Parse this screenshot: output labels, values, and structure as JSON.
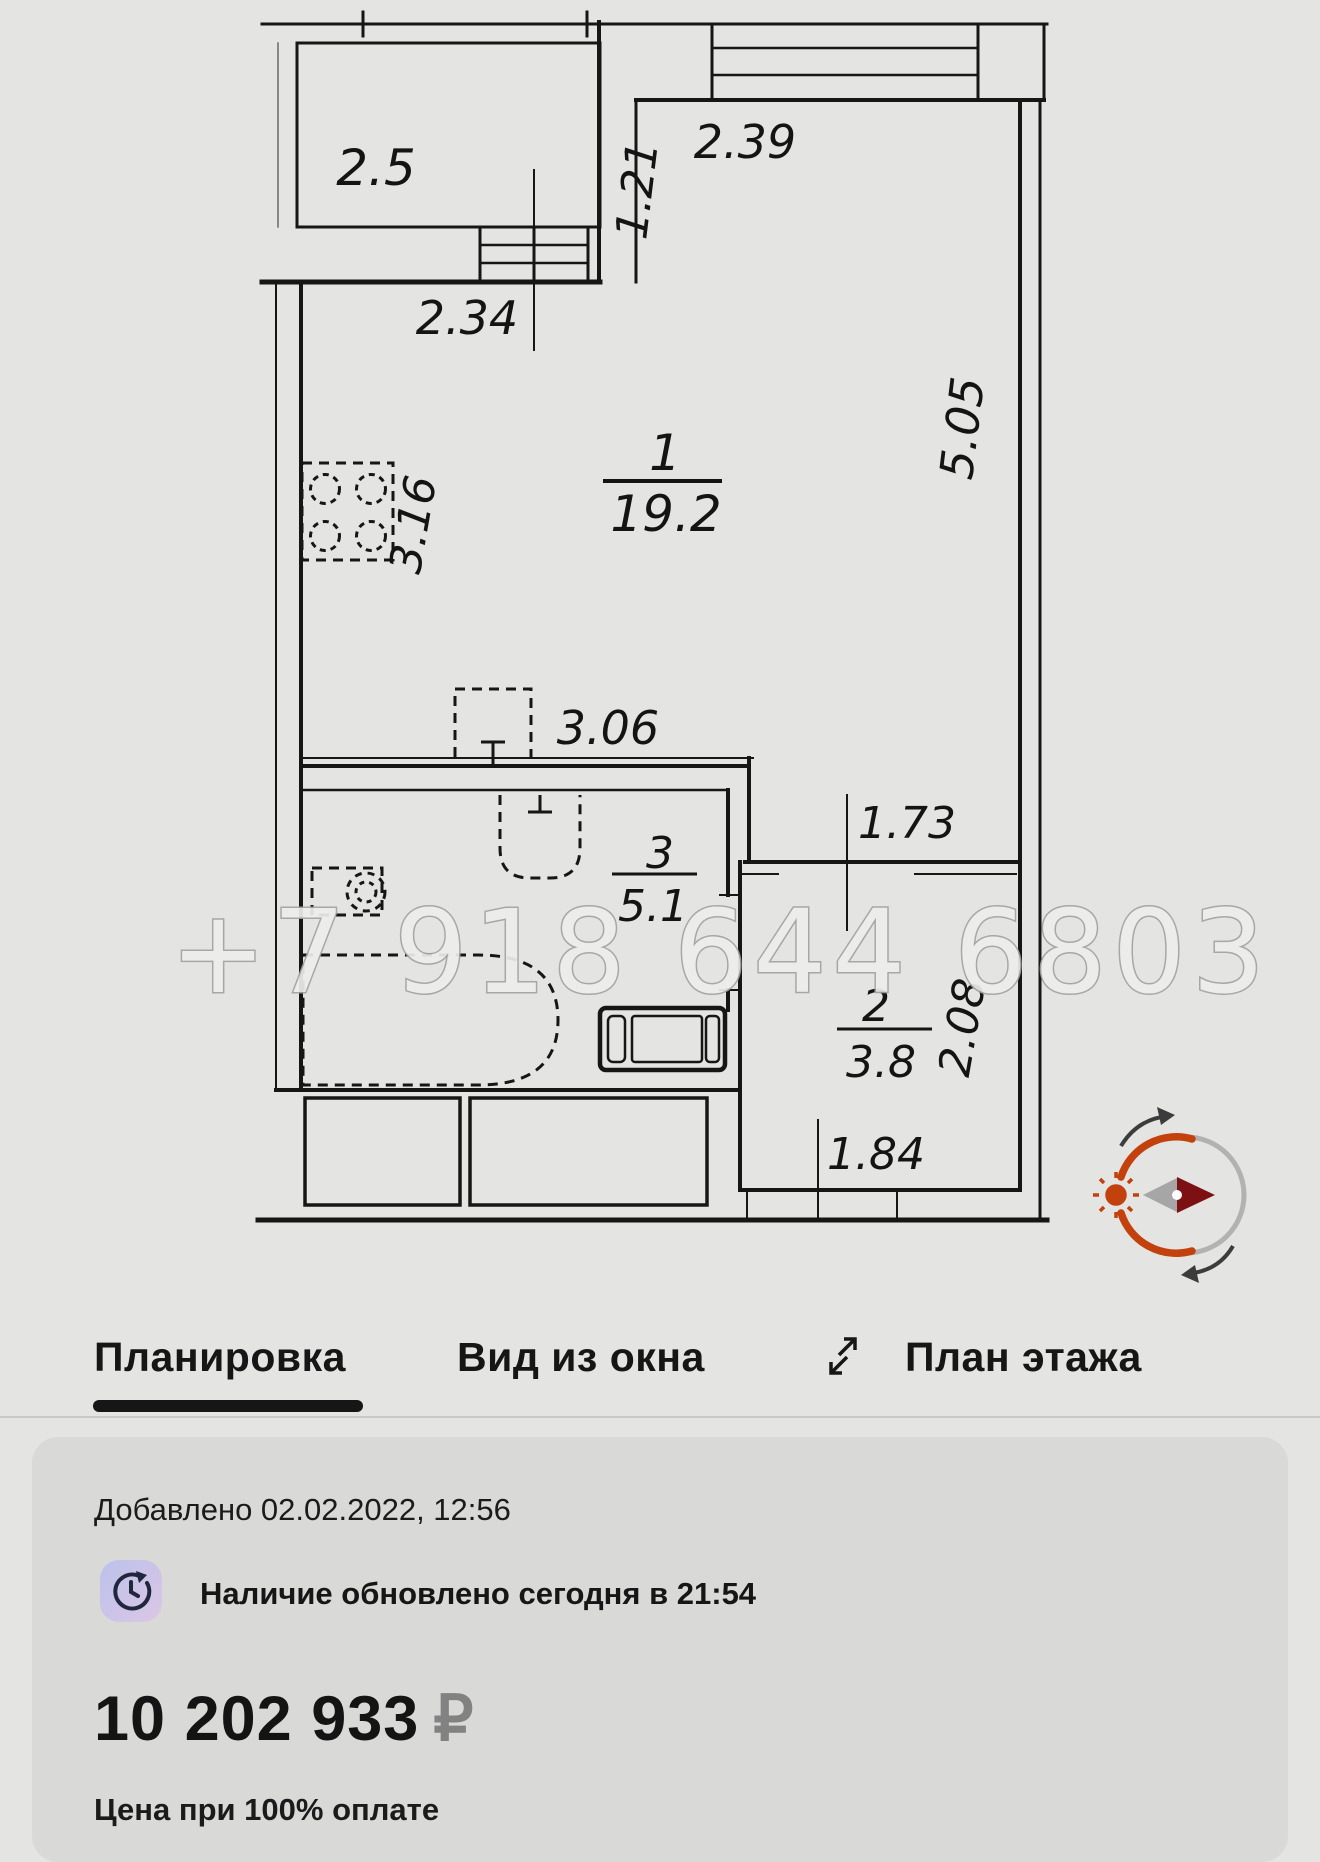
{
  "plan": {
    "watermark": "+7 918 644 6803",
    "rooms": {
      "room1": {
        "num": "1",
        "area": "19.2"
      },
      "room2": {
        "num": "2",
        "area": "3.8"
      },
      "room3": {
        "num": "3",
        "area": "5.1"
      },
      "balcony": {
        "area": "2.5"
      }
    },
    "dims": {
      "d239": "2.39",
      "d121": "1.21",
      "d234": "2.34",
      "d316": "3.16",
      "d505": "5.05",
      "d306": "3.06",
      "d173": "1.73",
      "d208": "2.08",
      "d184": "1.84"
    }
  },
  "tabs": {
    "layout": "Планировка",
    "window_view": "Вид из окна",
    "floor_plan": "План этажа"
  },
  "card": {
    "added": "Добавлено 02.02.2022, 12:56",
    "availability": "Наличие обновлено сегодня в 21:54",
    "price": "10 202 933",
    "currency": "₽",
    "price_note": "Цена при 100% оплате"
  },
  "colors": {
    "accent_red": "#c2410c",
    "needle_dark": "#7d1013",
    "page_bg": "#e4e4e2",
    "card_bg": "#d9d9d7"
  }
}
